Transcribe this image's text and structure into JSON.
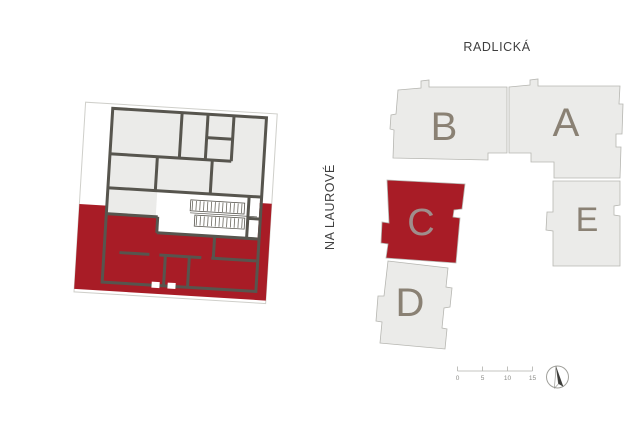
{
  "colors": {
    "highlight": "#a81c26",
    "building_fill": "#ebebe9",
    "building_outline": "#b6b6b1",
    "wall": "#57554e",
    "site_boundary": "#cfcfca",
    "building_label": "#8a8174",
    "highlighted_building_label": "#9f8e8c",
    "street_label": "#3f3f3f",
    "scale_bar": "#8c8c88"
  },
  "streets": {
    "top": "RADLICKÁ",
    "left": "NA LAUROVÉ"
  },
  "site_plan": {
    "highlighted_building": "C",
    "buildings": [
      {
        "label": "B",
        "highlighted": false
      },
      {
        "label": "A",
        "highlighted": false
      },
      {
        "label": "C",
        "highlighted": true
      },
      {
        "label": "D",
        "highlighted": false
      },
      {
        "label": "E",
        "highlighted": false
      }
    ]
  },
  "scale_bar": {
    "ticks": [
      "0",
      "5",
      "10",
      "15"
    ]
  }
}
